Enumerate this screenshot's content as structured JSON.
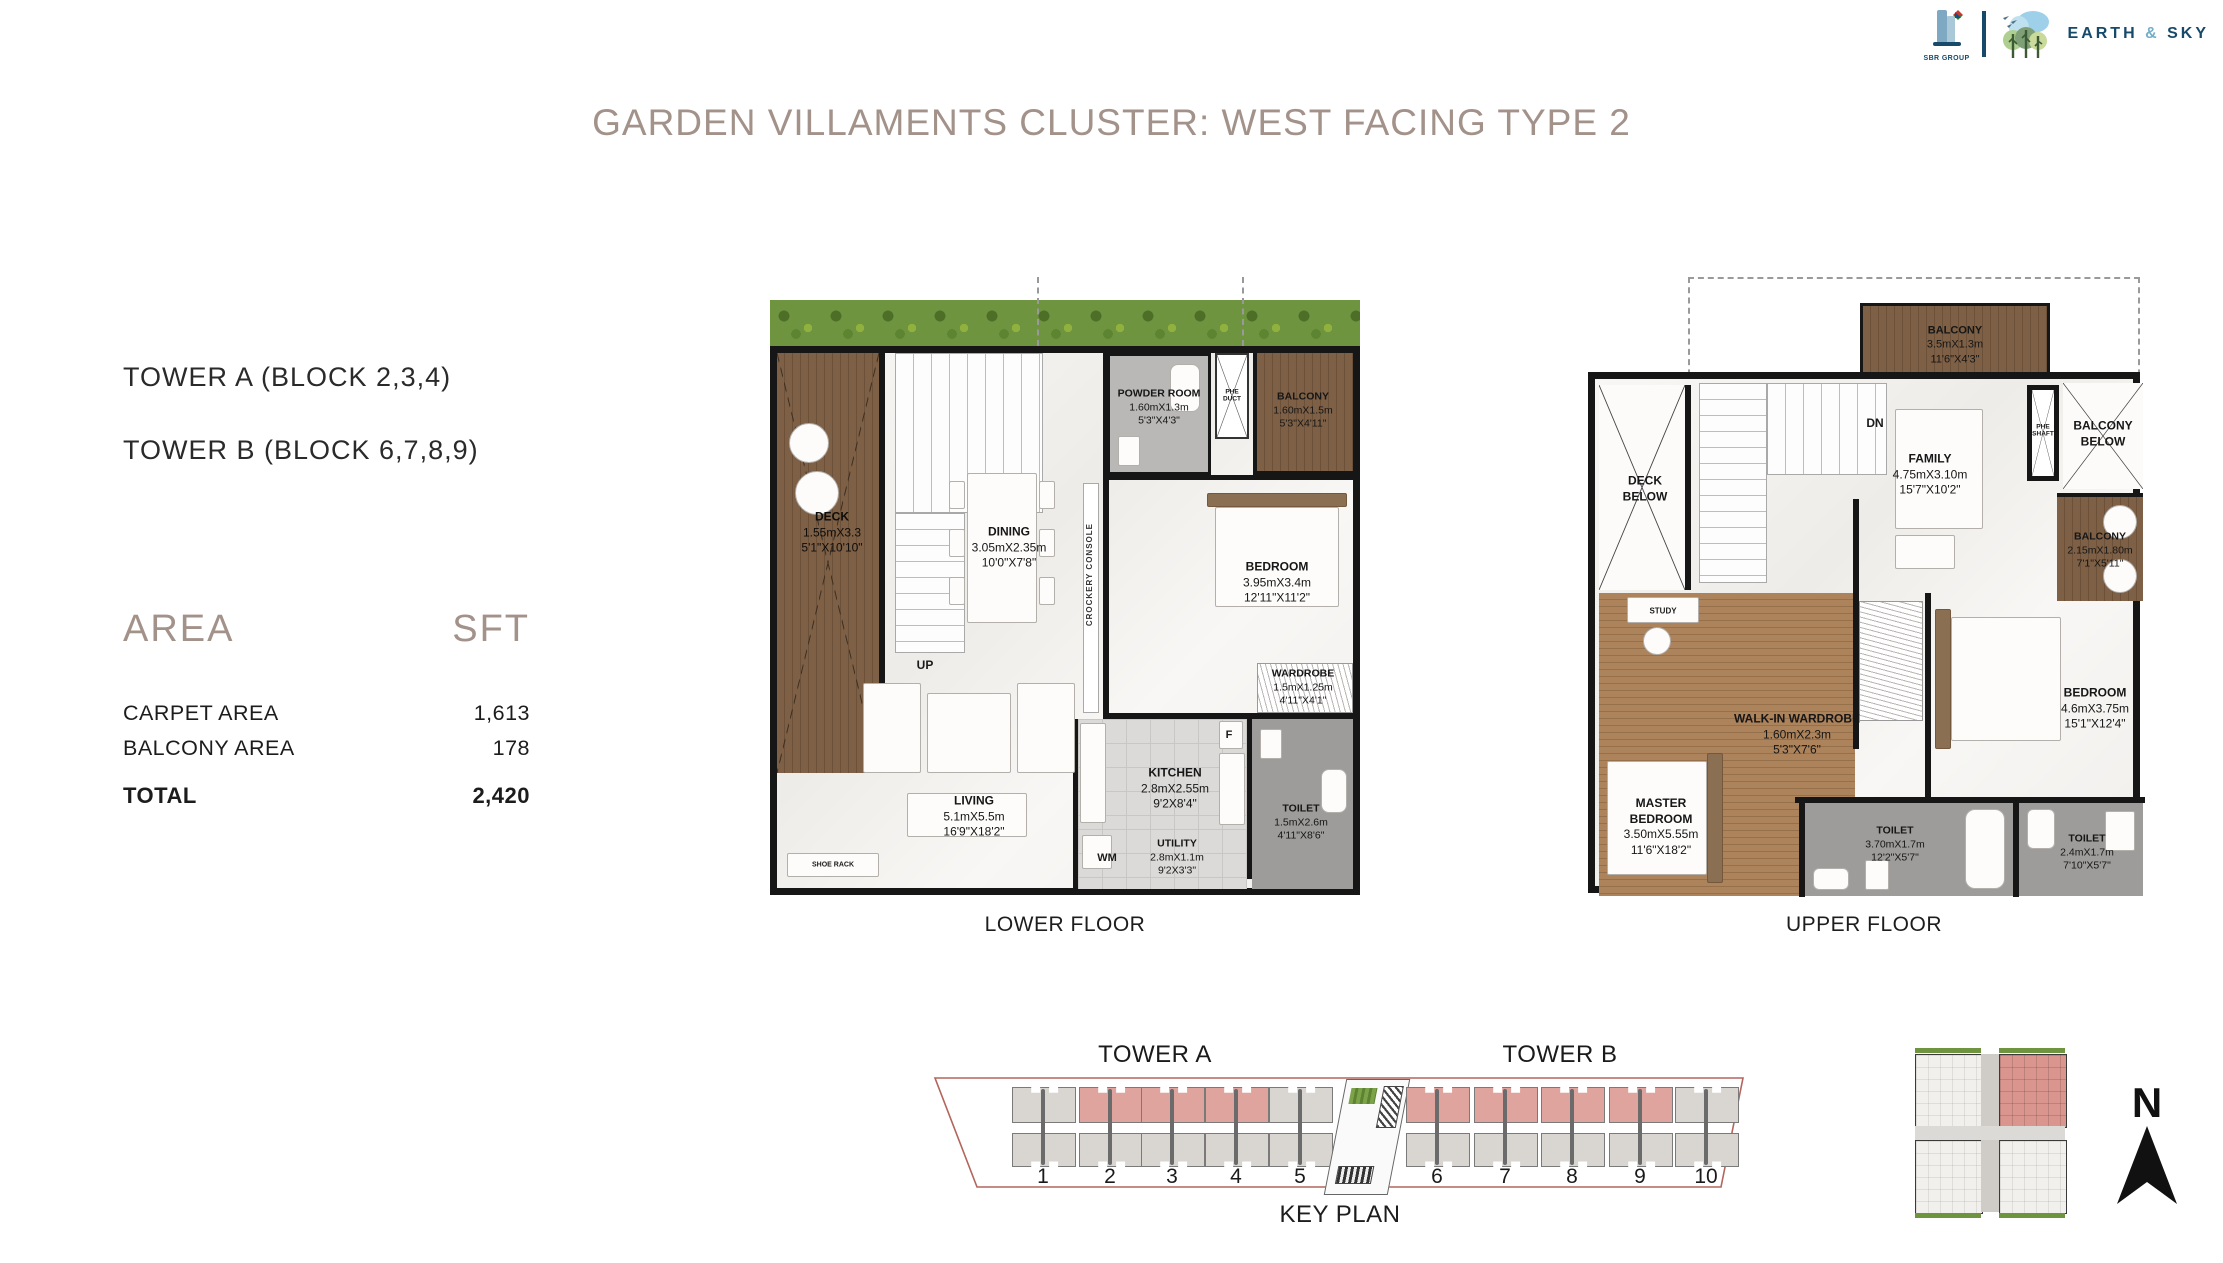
{
  "header": {
    "title": "GARDEN VILLAMENTS CLUSTER: WEST FACING TYPE 2",
    "logos": {
      "sbr_group": "SBR GROUP",
      "earth": "EARTH",
      "amp": "&",
      "sky": "SKY"
    }
  },
  "info": {
    "tower_a": "TOWER A (BLOCK 2,3,4)",
    "tower_b": "TOWER B (BLOCK 6,7,8,9)",
    "area_header": "AREA",
    "sft_header": "SFT",
    "rows": [
      {
        "label": "CARPET AREA",
        "value": "1,613"
      },
      {
        "label": "BALCONY AREA",
        "value": "178"
      }
    ],
    "total_label": "TOTAL",
    "total_value": "2,420"
  },
  "lower_floor": {
    "caption": "LOWER FLOOR",
    "rooms": {
      "deck": {
        "name": "DECK",
        "dim_m": "1.55mX3.3",
        "dim_ft": "5'1\"X10'10\""
      },
      "powder_room": {
        "name": "POWDER ROOM",
        "dim_m": "1.60mX1.3m",
        "dim_ft": "5'3\"X4'3\""
      },
      "balcony": {
        "name": "BALCONY",
        "dim_m": "1.60mX1.5m",
        "dim_ft": "5'3\"X4'11\""
      },
      "dining": {
        "name": "DINING",
        "dim_m": "3.05mX2.35m",
        "dim_ft": "10'0\"X7'8\""
      },
      "bedroom": {
        "name": "BEDROOM",
        "dim_m": "3.95mX3.4m",
        "dim_ft": "12'11\"X11'2\""
      },
      "wardrobe": {
        "name": "WARDROBE",
        "dim_m": "1.5mX1.25m",
        "dim_ft": "4'11\"X4'1\""
      },
      "kitchen": {
        "name": "KITCHEN",
        "dim_m": "2.8mX2.55m",
        "dim_ft": "9'2X8'4\""
      },
      "living": {
        "name": "LIVING",
        "dim_m": "5.1mX5.5m",
        "dim_ft": "16'9\"X18'2\""
      },
      "toilet": {
        "name": "TOILET",
        "dim_m": "1.5mX2.6m",
        "dim_ft": "4'11\"X8'6\""
      },
      "utility": {
        "name": "UTILITY",
        "dim_m": "2.8mX1.1m",
        "dim_ft": "9'2X3'3\""
      }
    },
    "small_labels": {
      "up": "UP",
      "wm": "WM",
      "fridge": "F",
      "shoe_rack": "SHOE RACK",
      "phe_duct": "PHE\nDUCT",
      "crockery_console": "CROCKERY CONSOLE"
    }
  },
  "upper_floor": {
    "caption": "UPPER FLOOR",
    "rooms": {
      "balcony_top": {
        "name": "BALCONY",
        "dim_m": "3.5mX1.3m",
        "dim_ft": "11'6\"X4'3\""
      },
      "family": {
        "name": "FAMILY",
        "dim_m": "4.75mX3.10m",
        "dim_ft": "15'7\"X10'2\""
      },
      "balcony_right": {
        "name": "BALCONY",
        "dim_m": "2.15mX1.80m",
        "dim_ft": "7'1\"X5'11\""
      },
      "walk_in_wardrobe": {
        "name": "WALK-IN WARDROBE",
        "dim_m": "1.60mX2.3m",
        "dim_ft": "5'3\"X7'6\""
      },
      "bedroom": {
        "name": "BEDROOM",
        "dim_m": "4.6mX3.75m",
        "dim_ft": "15'1\"X12'4\""
      },
      "master_bedroom": {
        "name": "MASTER\nBEDROOM",
        "dim_m": "3.50mX5.55m",
        "dim_ft": "11'6\"X18'2\""
      },
      "toilet_1": {
        "name": "TOILET",
        "dim_m": "3.70mX1.7m",
        "dim_ft": "12'2\"X5'7\""
      },
      "toilet_2": {
        "name": "TOILET",
        "dim_m": "2.4mX1.7m",
        "dim_ft": "7'10\"X5'7\""
      },
      "deck_below": {
        "name": "DECK\nBELOW"
      },
      "balcony_below": {
        "name": "BALCONY\nBELOW"
      }
    },
    "small_labels": {
      "dn": "DN",
      "study": "STUDY",
      "phe_shaft": "PHE\nSHAFT"
    }
  },
  "key_plan": {
    "tower_a_label": "TOWER A",
    "tower_b_label": "TOWER B",
    "caption": "KEY PLAN",
    "unit_numbers": [
      "1",
      "2",
      "3",
      "4",
      "5",
      "6",
      "7",
      "8",
      "9",
      "10"
    ],
    "highlighted_units": [
      "2",
      "3",
      "4",
      "6",
      "7",
      "8",
      "9"
    ]
  },
  "compass": {
    "north_label": "N"
  },
  "colors": {
    "accent": "#a3928a",
    "highlight": "#dfa49e",
    "highlight_strong": "#d9958e",
    "garden_green": "#6f9440",
    "deck_wood": "#7d6046",
    "floor_wood": "#ad835c",
    "wall": "#161616",
    "keyplan_outline": "#b3655c",
    "logo_navy": "#17496b"
  }
}
